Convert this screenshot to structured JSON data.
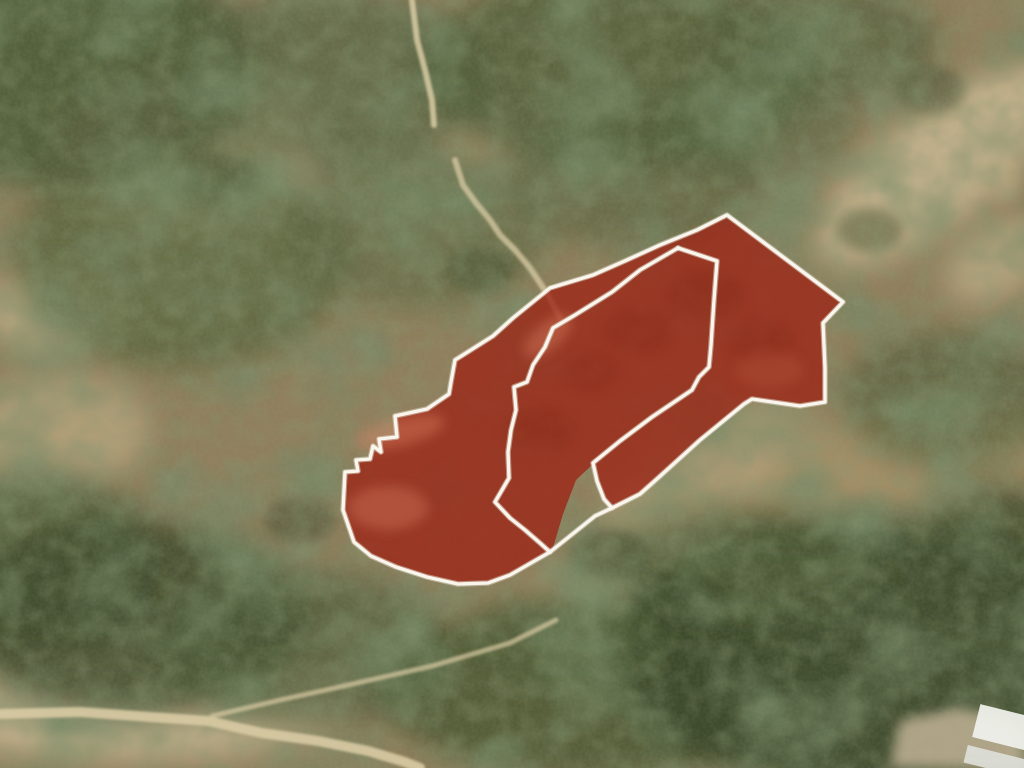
{
  "map": {
    "type": "satellite aerial imagery",
    "description": "hillside scrubland with highlighted land parcels for sale",
    "highlighted_parcel_count": 3,
    "colors": {
      "parcel_fill": "#9c2414",
      "parcel_fill_opacity": "0.78",
      "boundary_stroke": "#faf6ee",
      "terrain_base": "#8f7f5d",
      "road": "#d9cba4",
      "structure_white": "#eef0ea"
    },
    "parcel_outline": {
      "outer": [
        [
          727,
          215
        ],
        [
          843,
          302
        ],
        [
          823,
          323
        ],
        [
          825,
          368
        ],
        [
          825,
          402
        ],
        [
          800,
          406
        ],
        [
          752,
          399
        ],
        [
          744,
          404
        ],
        [
          700,
          440
        ],
        [
          658,
          478
        ],
        [
          640,
          494
        ],
        [
          612,
          508
        ],
        [
          595,
          516
        ],
        [
          565,
          540
        ],
        [
          550,
          552
        ],
        [
          510,
          575
        ],
        [
          488,
          583
        ],
        [
          458,
          584
        ],
        [
          427,
          577
        ],
        [
          396,
          567
        ],
        [
          371,
          556
        ],
        [
          354,
          542
        ],
        [
          343,
          510
        ],
        [
          345,
          472
        ],
        [
          358,
          471
        ],
        [
          356,
          460
        ],
        [
          370,
          459
        ],
        [
          373,
          446
        ],
        [
          381,
          452
        ],
        [
          379,
          439
        ],
        [
          397,
          437
        ],
        [
          395,
          416
        ],
        [
          427,
          409
        ],
        [
          449,
          394
        ],
        [
          451,
          382
        ],
        [
          455,
          360
        ],
        [
          493,
          336
        ],
        [
          513,
          318
        ],
        [
          550,
          288
        ],
        [
          593,
          275
        ],
        [
          627,
          260
        ],
        [
          660,
          245
        ],
        [
          697,
          230
        ]
      ],
      "notch": [
        [
          593,
          464
        ],
        [
          597,
          481
        ],
        [
          603,
          498
        ],
        [
          610,
          507
        ],
        [
          595,
          515
        ],
        [
          566,
          539
        ],
        [
          552,
          551
        ],
        [
          563,
          514
        ],
        [
          576,
          480
        ]
      ],
      "divider_left": [
        [
          678,
          248
        ],
        [
          640,
          270
        ],
        [
          612,
          292
        ],
        [
          575,
          315
        ],
        [
          553,
          328
        ],
        [
          545,
          347
        ],
        [
          533,
          365
        ],
        [
          527,
          382
        ],
        [
          514,
          387
        ],
        [
          516,
          410
        ],
        [
          511,
          430
        ],
        [
          508,
          452
        ],
        [
          509,
          478
        ],
        [
          495,
          502
        ],
        [
          510,
          518
        ],
        [
          525,
          530
        ],
        [
          540,
          543
        ],
        [
          550,
          552
        ]
      ],
      "divider_right": [
        [
          678,
          248
        ],
        [
          717,
          261
        ],
        [
          714,
          300
        ],
        [
          711,
          345
        ],
        [
          709,
          367
        ],
        [
          699,
          377
        ],
        [
          692,
          390
        ],
        [
          652,
          417
        ],
        [
          620,
          441
        ],
        [
          593,
          463
        ],
        [
          597,
          481
        ],
        [
          604,
          499
        ],
        [
          612,
          508
        ]
      ]
    },
    "trails": {
      "trail_top_a": [
        [
          412,
          0
        ],
        [
          417,
          40
        ],
        [
          425,
          70
        ],
        [
          432,
          100
        ],
        [
          434,
          125
        ]
      ],
      "trail_top_b": [
        [
          455,
          160
        ],
        [
          463,
          185
        ],
        [
          476,
          203
        ],
        [
          490,
          220
        ],
        [
          500,
          235
        ],
        [
          515,
          250
        ],
        [
          530,
          268
        ],
        [
          548,
          295
        ],
        [
          560,
          318
        ]
      ],
      "road_bottom": [
        [
          0,
          714
        ],
        [
          80,
          712
        ],
        [
          150,
          717
        ],
        [
          208,
          721
        ],
        [
          262,
          733
        ],
        [
          318,
          741
        ],
        [
          368,
          751
        ],
        [
          405,
          762
        ],
        [
          420,
          768
        ]
      ],
      "road_branch": [
        [
          212,
          716
        ],
        [
          280,
          700
        ],
        [
          335,
          688
        ],
        [
          432,
          666
        ],
        [
          510,
          643
        ],
        [
          556,
          620
        ]
      ]
    }
  }
}
